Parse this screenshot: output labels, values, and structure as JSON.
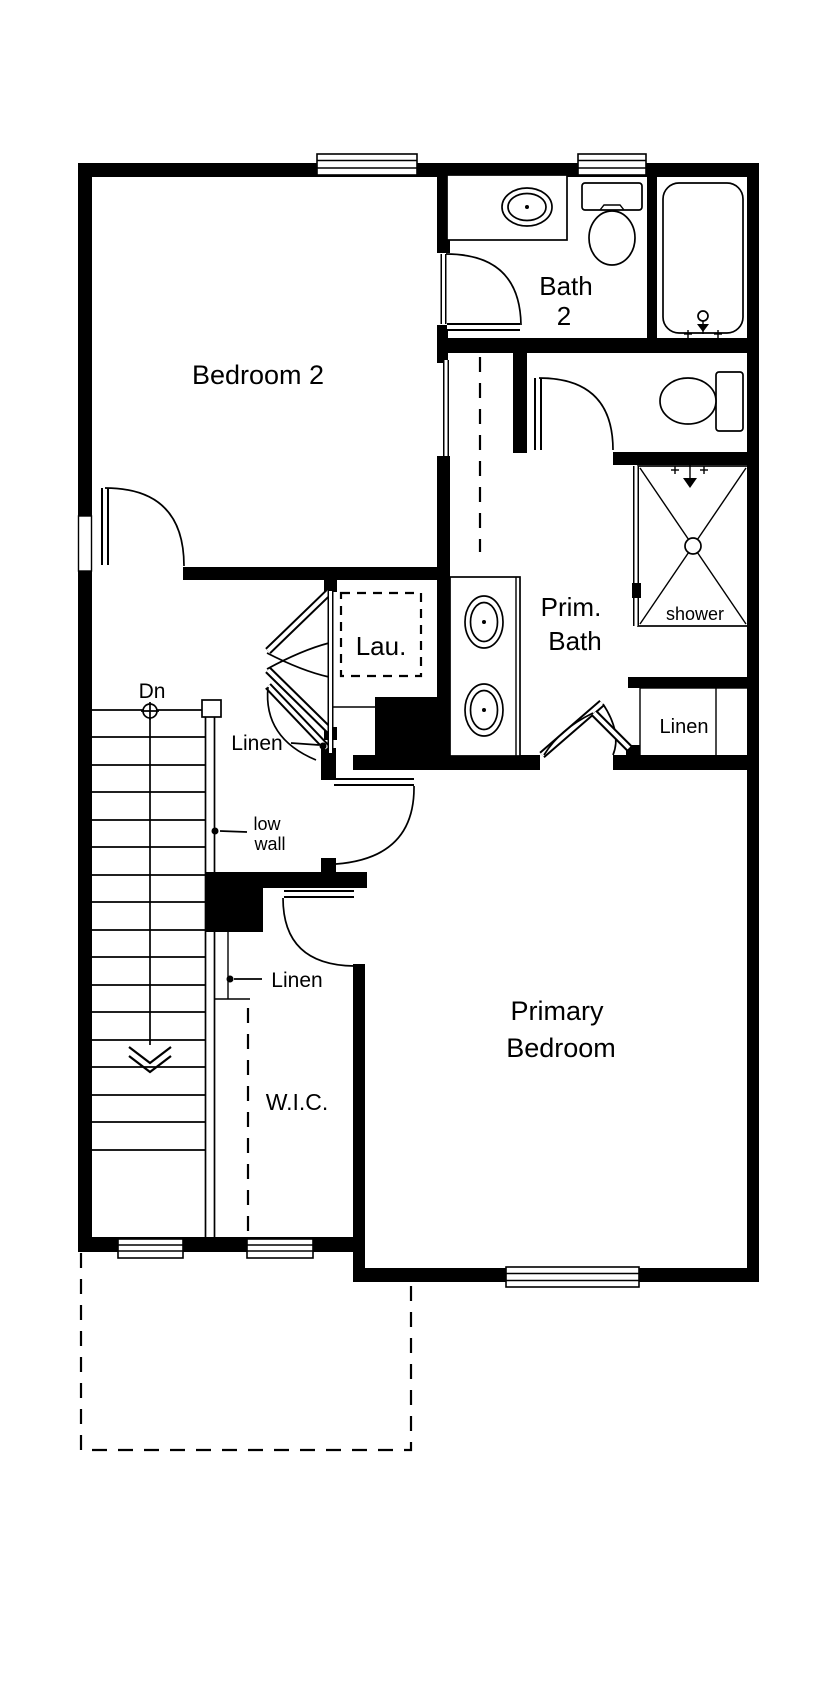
{
  "plan": {
    "rooms": {
      "bedroom2": {
        "label": "Bedroom 2"
      },
      "bath2": {
        "line1": "Bath",
        "line2": "2"
      },
      "prim_bath": {
        "line1": "Prim.",
        "line2": "Bath"
      },
      "primary_bedroom": {
        "line1": "Primary",
        "line2": "Bedroom"
      },
      "wic": {
        "label": "W.I.C."
      },
      "laundry": {
        "label": "Lau."
      }
    },
    "annotations": {
      "stairs_direction": "Dn",
      "shower": "shower",
      "linen_hall": "Linen",
      "linen_wic": "Linen",
      "linen_bath": "Linen",
      "low_wall_line1": "low",
      "low_wall_line2": "wall"
    },
    "colors": {
      "wall": "#000000",
      "background": "#ffffff"
    }
  }
}
